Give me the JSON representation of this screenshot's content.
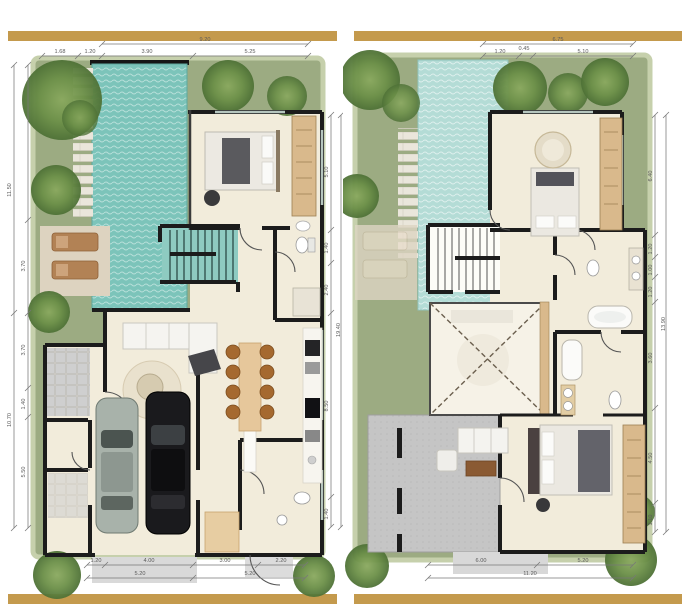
{
  "colors": {
    "accent_gold": "#c49a4d",
    "grass": "#9cab82",
    "grass_edge": "#c6d0ac",
    "pool_water_ground": "#7cc4ba",
    "pool_water_upper": "#b4dcd6",
    "floor": "#f2ecdb",
    "wall": "#1c1c1c",
    "wood": "#d9b98c",
    "terrace_gray": "#c5c5c5",
    "car_black": "#1a1a1d",
    "car_silver": "#a8b2aa"
  },
  "ground_floor": {
    "dims_top": {
      "overall": "9.20",
      "segments": [
        "1.68",
        "1.20",
        "3.90",
        "5.25"
      ]
    },
    "dims_bottom_row1": [
      "1.20",
      "4.00",
      "3.00",
      "2.20"
    ],
    "dims_bottom_row2": [
      "5.20",
      "5.20"
    ],
    "dims_left": {
      "overall_upper": "11.50",
      "overall_lower": "10.70",
      "segments": [
        "3.70",
        "3.70",
        "1.40",
        "5.50"
      ]
    },
    "dims_right": {
      "overall": "19.40",
      "segments": [
        "5.10",
        "1.40",
        "2.40",
        "8.50",
        "1.40"
      ]
    }
  },
  "upper_floor": {
    "dims_top": {
      "overall": "6.75",
      "segments": [
        "1.20",
        "0.45",
        "5.10"
      ]
    },
    "dims_bottom_row1": [
      "6.00",
      "5.20"
    ],
    "dims_bottom_row2": [
      "11.20"
    ],
    "dims_right": {
      "overall": "13.90",
      "segments": [
        "6.40",
        "1.20",
        "1.00",
        "1.20",
        "3.60",
        "4.50",
        "1.10"
      ]
    }
  }
}
